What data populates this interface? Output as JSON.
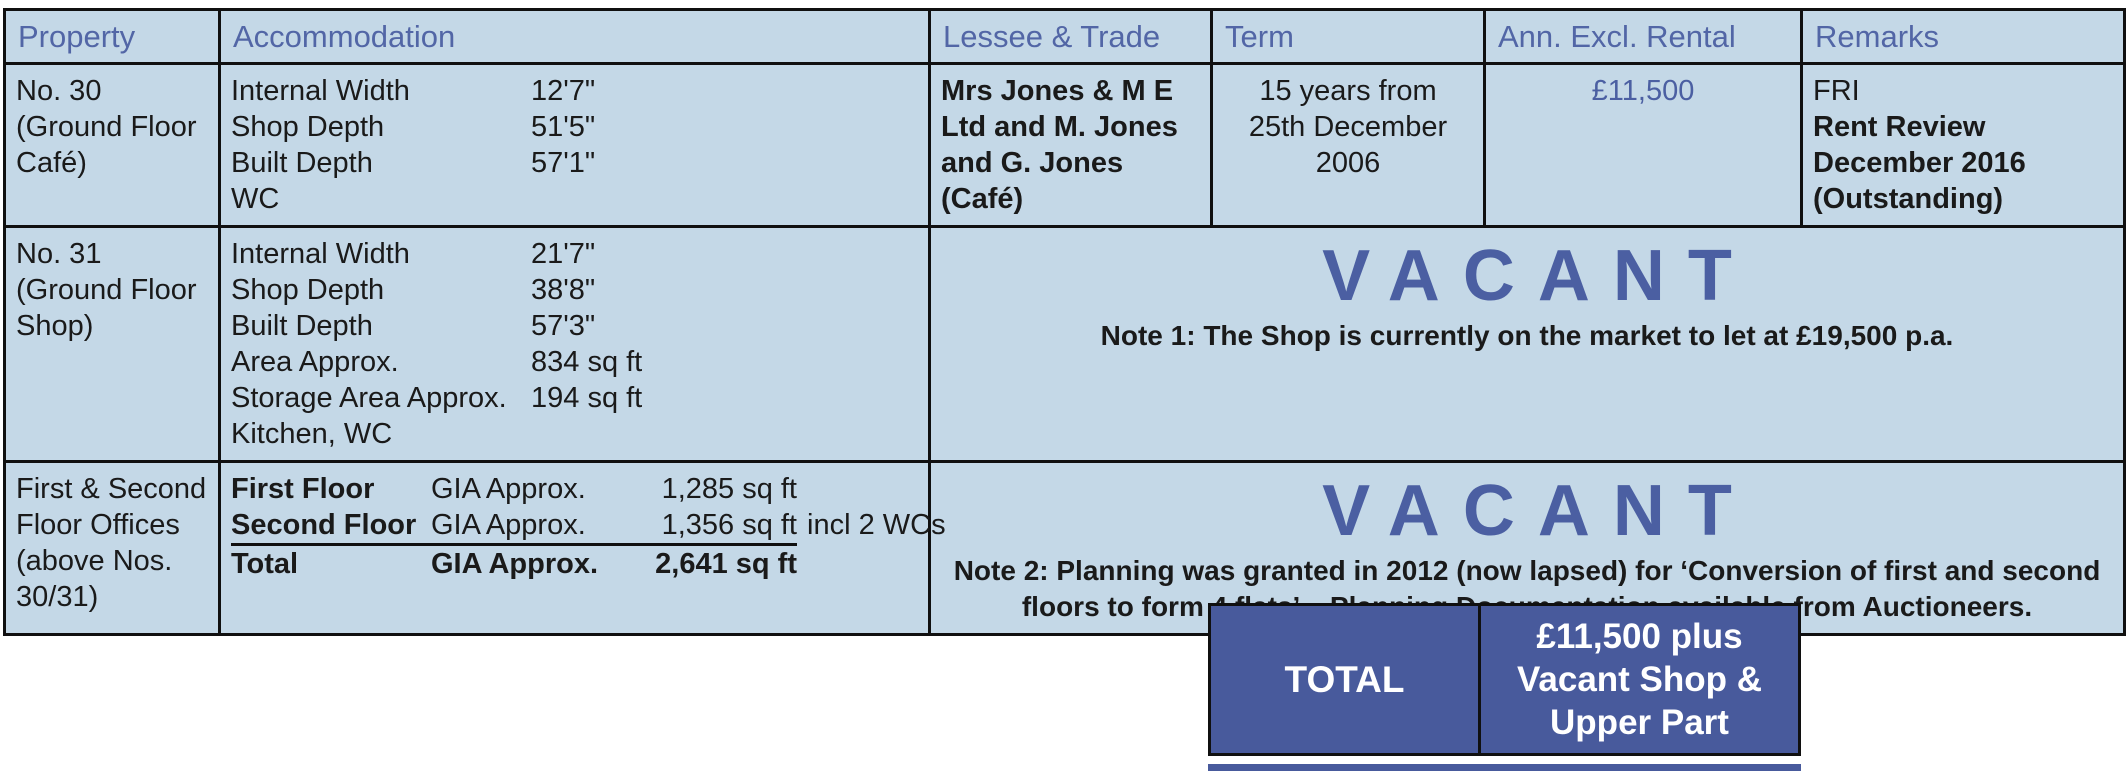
{
  "colors": {
    "cell_background": "#c4d8e7",
    "header_text": "#5266a6",
    "accent_text": "#4b5fa2",
    "total_box_background": "#485a9c",
    "total_box_text": "#ffffff",
    "border": "#101010",
    "body_text": "#1a1a1a"
  },
  "header": {
    "property": "Property",
    "accommodation": "Accommodation",
    "lessee": "Lessee & Trade",
    "term": "Term",
    "rental": "Ann. Excl. Rental",
    "remarks": "Remarks"
  },
  "row1": {
    "property": "No. 30\n(Ground Floor\nCafé)",
    "acc_labels": "Internal Width\nShop Depth\nBuilt Depth\nWC",
    "acc_values": "12'7\"\n51'5\"\n57'1\"",
    "lessee": "Mrs Jones & M E\nLtd and M. Jones\nand G. Jones\n(Café)",
    "term": "15 years from\n25th December\n2006",
    "rental": "£11,500",
    "remarks_plain": "FRI",
    "remarks_bold": "Rent Review\nDecember 2016\n(Outstanding)"
  },
  "row2": {
    "property": "No. 31\n(Ground Floor\nShop)",
    "acc_labels": "Internal Width\nShop Depth\nBuilt Depth\nArea Approx.\nStorage Area Approx.\nKitchen, WC",
    "acc_values": "21'7\"\n38'8\"\n57'3\"\n834 sq ft\n194 sq ft",
    "status": "VACANT",
    "note": "Note 1: The Shop is currently on the market to let at £19,500 p.a."
  },
  "row3": {
    "property": "First & Second\nFloor Offices\n(above Nos.\n30/31)",
    "lines": [
      {
        "label": "First Floor",
        "gia": "GIA Approx.",
        "value": "1,285 sq ft",
        "suffix": ""
      },
      {
        "label": "Second Floor",
        "gia": "GIA Approx.",
        "value": "1,356 sq ft",
        "suffix": "incl 2 WCs"
      },
      {
        "label": "Total",
        "gia": "GIA Approx.",
        "value": "2,641 sq ft",
        "suffix": ""
      }
    ],
    "status": "VACANT",
    "note": "Note 2: Planning was granted in 2012 (now lapsed) for ‘Conversion of first and second\nfloors to form 4 flats’ – Planning Documentation available from Auctioneers."
  },
  "total": {
    "label": "TOTAL",
    "value": "£11,500 plus\nVacant Shop &\nUpper Part"
  }
}
